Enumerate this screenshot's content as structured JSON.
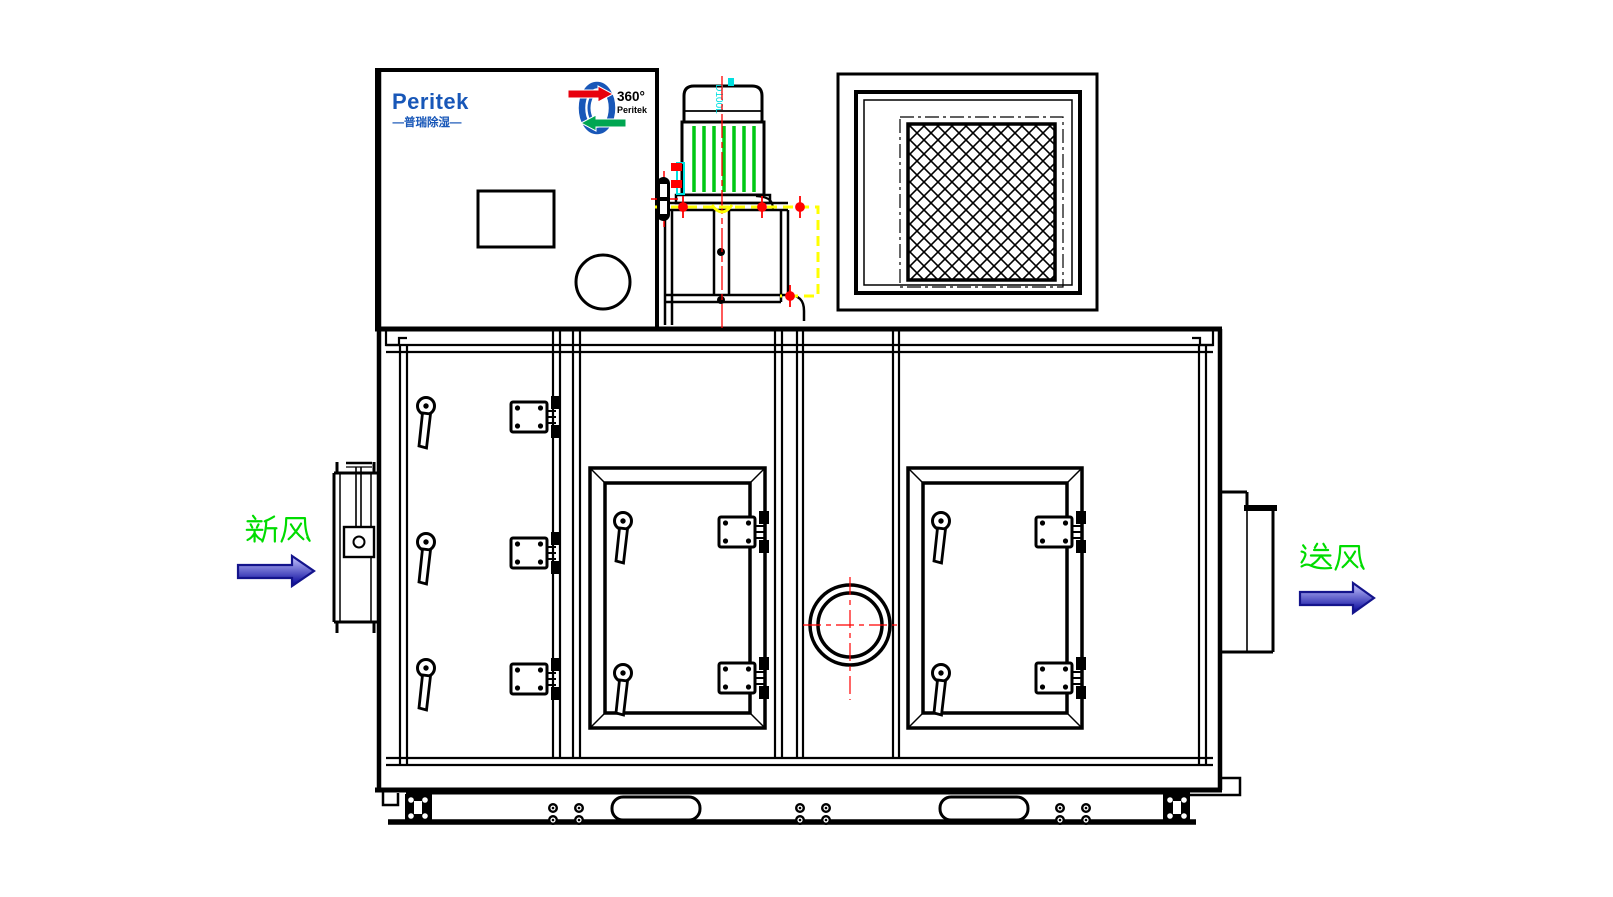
{
  "branding": {
    "name": "Peritek",
    "tagline": "—普瑞除湿—",
    "rotor_degree": "360°",
    "rotor_brand": "Peritek"
  },
  "annotations": {
    "fresh_air": "新风",
    "supply_air": "送风",
    "motor_model": "D100L"
  },
  "colors": {
    "line_black": "#000000",
    "brand_blue": "#1857b8",
    "logo_red": "#e8000d",
    "logo_green": "#00a651",
    "motor_fin_green": "#00c814",
    "centerline_red": "#ff0000",
    "guard_yellow": "#ffff00",
    "clip_cyan": "#00e0e0",
    "label_green": "#00dc00",
    "arrow_fill_light": "#c8c8ff",
    "arrow_fill_dark": "#000099",
    "arrow_outline": "#14148c"
  }
}
